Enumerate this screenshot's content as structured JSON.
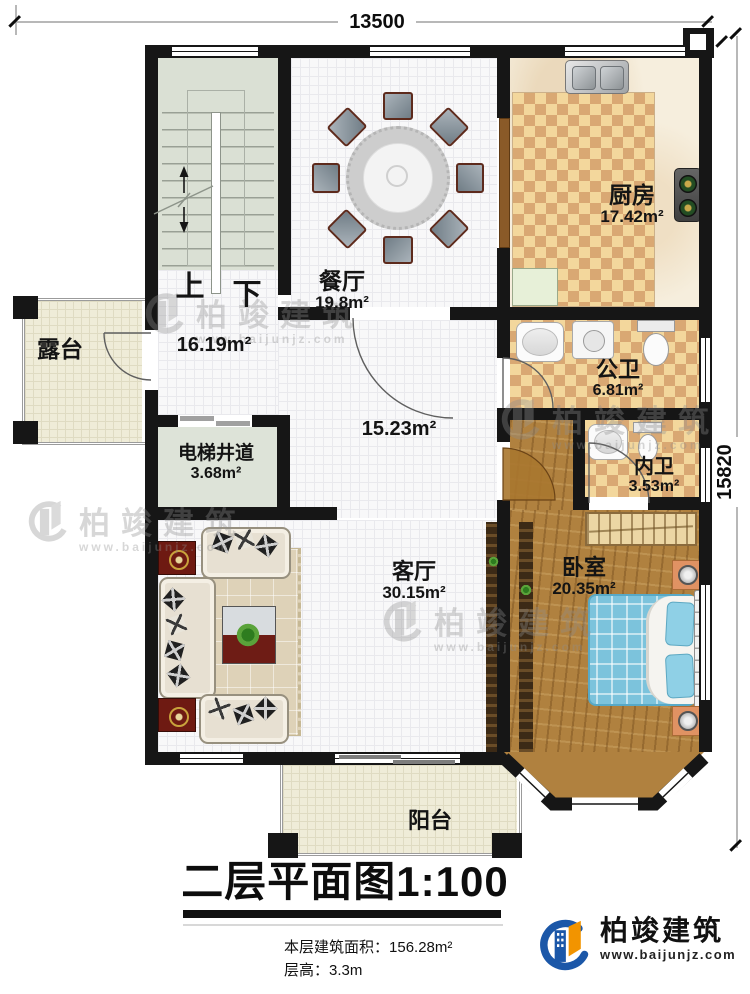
{
  "page": {
    "title_text": "二层平面图1:100"
  },
  "summary": {
    "area_label": "本层建筑面积：",
    "area_value": "156.28m²",
    "height_label": "层高：",
    "height_value": "3.3m"
  },
  "dimensions": {
    "width": "13500",
    "height": "15820"
  },
  "stairs": {
    "up": "上",
    "down": "下"
  },
  "rooms": {
    "dining": {
      "name": "餐厅",
      "area": "19.8m²"
    },
    "kitchen": {
      "name": "厨房",
      "area": "17.42m²"
    },
    "stair_hall": {
      "area": "16.19m²"
    },
    "terrace": {
      "name": "露台"
    },
    "elevator": {
      "name": "电梯井道",
      "area": "3.68m²"
    },
    "hall": {
      "area": "15.23m²"
    },
    "public_bath": {
      "name": "公卫",
      "area": "6.81m²"
    },
    "inner_bath": {
      "name": "内卫",
      "area": "3.53m²"
    },
    "bedroom": {
      "name": "卧室",
      "area": "20.35m²"
    },
    "living": {
      "name": "客厅",
      "area": "30.15m²"
    },
    "balcony": {
      "name": "阳台"
    }
  },
  "watermark": {
    "brand": "柏竣建筑",
    "url": "www.baijunjz.com"
  },
  "brand": {
    "name": "柏竣建筑",
    "url": "www.baijunjz.com"
  },
  "colors": {
    "wall": "#161616",
    "checker_light": "#f3d79c",
    "checker_dark": "#d9a873",
    "wood_floor": "#b0813f",
    "bed_blue": "#7cc3dc",
    "logo_blue": "#1b57a8",
    "logo_orange": "#f29400",
    "watermark_gray": "#8e8e8e"
  }
}
